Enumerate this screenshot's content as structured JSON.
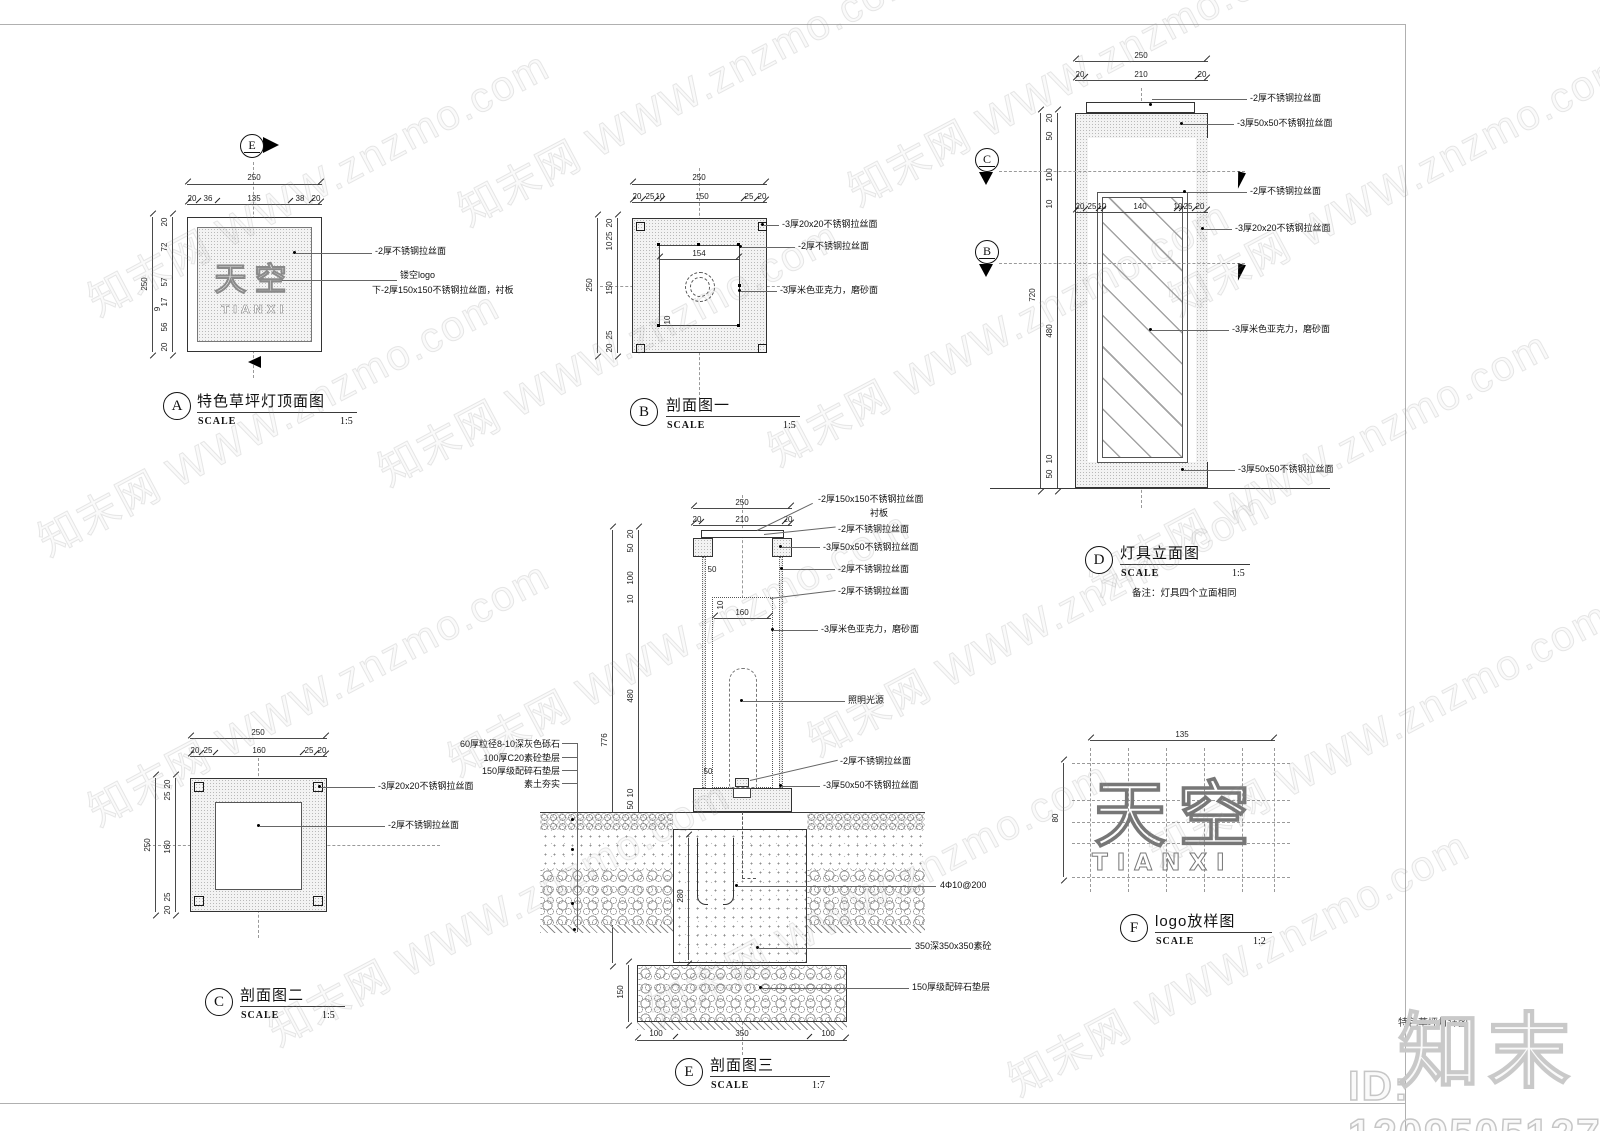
{
  "sheet": {
    "watermark_text": "知末网 WWW.znzmo.com",
    "brand_logo": "知末",
    "id_text": "ID: 1209505127",
    "title_block_text": "特色草坪灯详图"
  },
  "labels": {
    "scale": "SCALE"
  },
  "viewA": {
    "letter": "A",
    "title": "特色草坪灯顶面图",
    "scale": "1:5",
    "marker": "E",
    "logo_cn": "天空",
    "logo_en": "TIANXI",
    "dim_top_total": "250",
    "top_segs": [
      "20",
      "36",
      "135",
      "38",
      "20"
    ],
    "dim_left_total": "250",
    "left_segs": [
      "20",
      "72",
      "57",
      "17",
      "9",
      "56",
      "20"
    ],
    "ann1": "-2厚不锈钢拉丝面",
    "ann2": "镂空logo",
    "ann3": "下-2厚150x150不锈钢拉丝面，衬板"
  },
  "viewB": {
    "letter": "B",
    "title": "剖面图一",
    "scale": "1:5",
    "dim_top_total": "250",
    "top_segs": [
      "20",
      "25",
      "10",
      "150",
      "25",
      "20"
    ],
    "dim_left_total": "250",
    "left_segs": [
      "20",
      "25",
      "10",
      "150",
      "25",
      "20"
    ],
    "dim_inner": "154",
    "dim_small": "10",
    "ann1": "-3厚20x20不锈钢拉丝面",
    "ann2": "-2厚不锈钢拉丝面",
    "ann3": "-3厚米色亚克力，磨砂面"
  },
  "viewC": {
    "letter": "C",
    "title": "剖面图二",
    "scale": "1:5",
    "dim_top_total": "250",
    "top_segs": [
      "20",
      "25",
      "160",
      "25",
      "20"
    ],
    "dim_left_total": "250",
    "left_segs": [
      "20",
      "25",
      "160",
      "25",
      "20"
    ],
    "ann1": "-3厚20x20不锈钢拉丝面",
    "ann2": "-2厚不锈钢拉丝面"
  },
  "viewD": {
    "letter": "D",
    "title": "灯具立面图",
    "scale": "1:5",
    "note": "备注：灯具四个立面相同",
    "marker_c": "C",
    "marker_b": "B",
    "dim_top_total": "250",
    "top_segs": [
      "20",
      "210",
      "20"
    ],
    "dim_left_total": "720",
    "left_segs": [
      "20",
      "50",
      "100",
      "10",
      "480",
      "10",
      "50"
    ],
    "mid_segs": [
      "20",
      "25",
      "10",
      "140",
      "10",
      "25",
      "20"
    ],
    "ann1": "-2厚不锈钢拉丝面",
    "ann2": "-3厚50x50不锈钢拉丝面",
    "ann3": "-2厚不锈钢拉丝面",
    "ann4": "-3厚20x20不锈钢拉丝面",
    "ann5": "-3厚米色亚克力，磨砂面",
    "ann6": "-3厚50x50不锈钢拉丝面"
  },
  "viewE": {
    "letter": "E",
    "title": "剖面图三",
    "scale": "1:7",
    "dim_top_total": "250",
    "top_segs": [
      "20",
      "210",
      "20"
    ],
    "dim_left_total": "776",
    "left_segs": [
      "20",
      "50",
      "100",
      "10",
      "480",
      "10",
      "50"
    ],
    "dim_cap": "50",
    "dim_wall": "10",
    "dim_tube": "160",
    "dim_base": "50",
    "dim_footing": "280",
    "dim_cushion": "150",
    "bottom_segs": [
      "100",
      "350",
      "100"
    ],
    "left_ann1": "60厚粒径8-10深灰色砾石",
    "left_ann2": "100厚C20素砼垫层",
    "left_ann3": "150厚级配碎石垫层",
    "left_ann4": "素土夯实",
    "r_ann1": "-2厚150x150不锈钢拉丝面",
    "r_ann2": "衬板",
    "r_ann3": "-2厚不锈钢拉丝面",
    "r_ann4": "-3厚50x50不锈钢拉丝面",
    "r_ann5": "-2厚不锈钢拉丝面",
    "r_ann6": "-2厚不锈钢拉丝面",
    "r_ann7": "-3厚米色亚克力，磨砂面",
    "r_ann8": "照明光源",
    "r_ann9": "-2厚不锈钢拉丝面",
    "r_ann10": "-3厚50x50不锈钢拉丝面",
    "r_ann11": "4Φ10@200",
    "r_ann12": "350深350x350素砼",
    "r_ann13": "150厚级配碎石垫层"
  },
  "viewF": {
    "letter": "F",
    "title": "logo放样图",
    "scale": "1:2",
    "dim_width": "135",
    "dim_height": "80",
    "logo_cn": "天空",
    "logo_en": "TIANXI"
  }
}
